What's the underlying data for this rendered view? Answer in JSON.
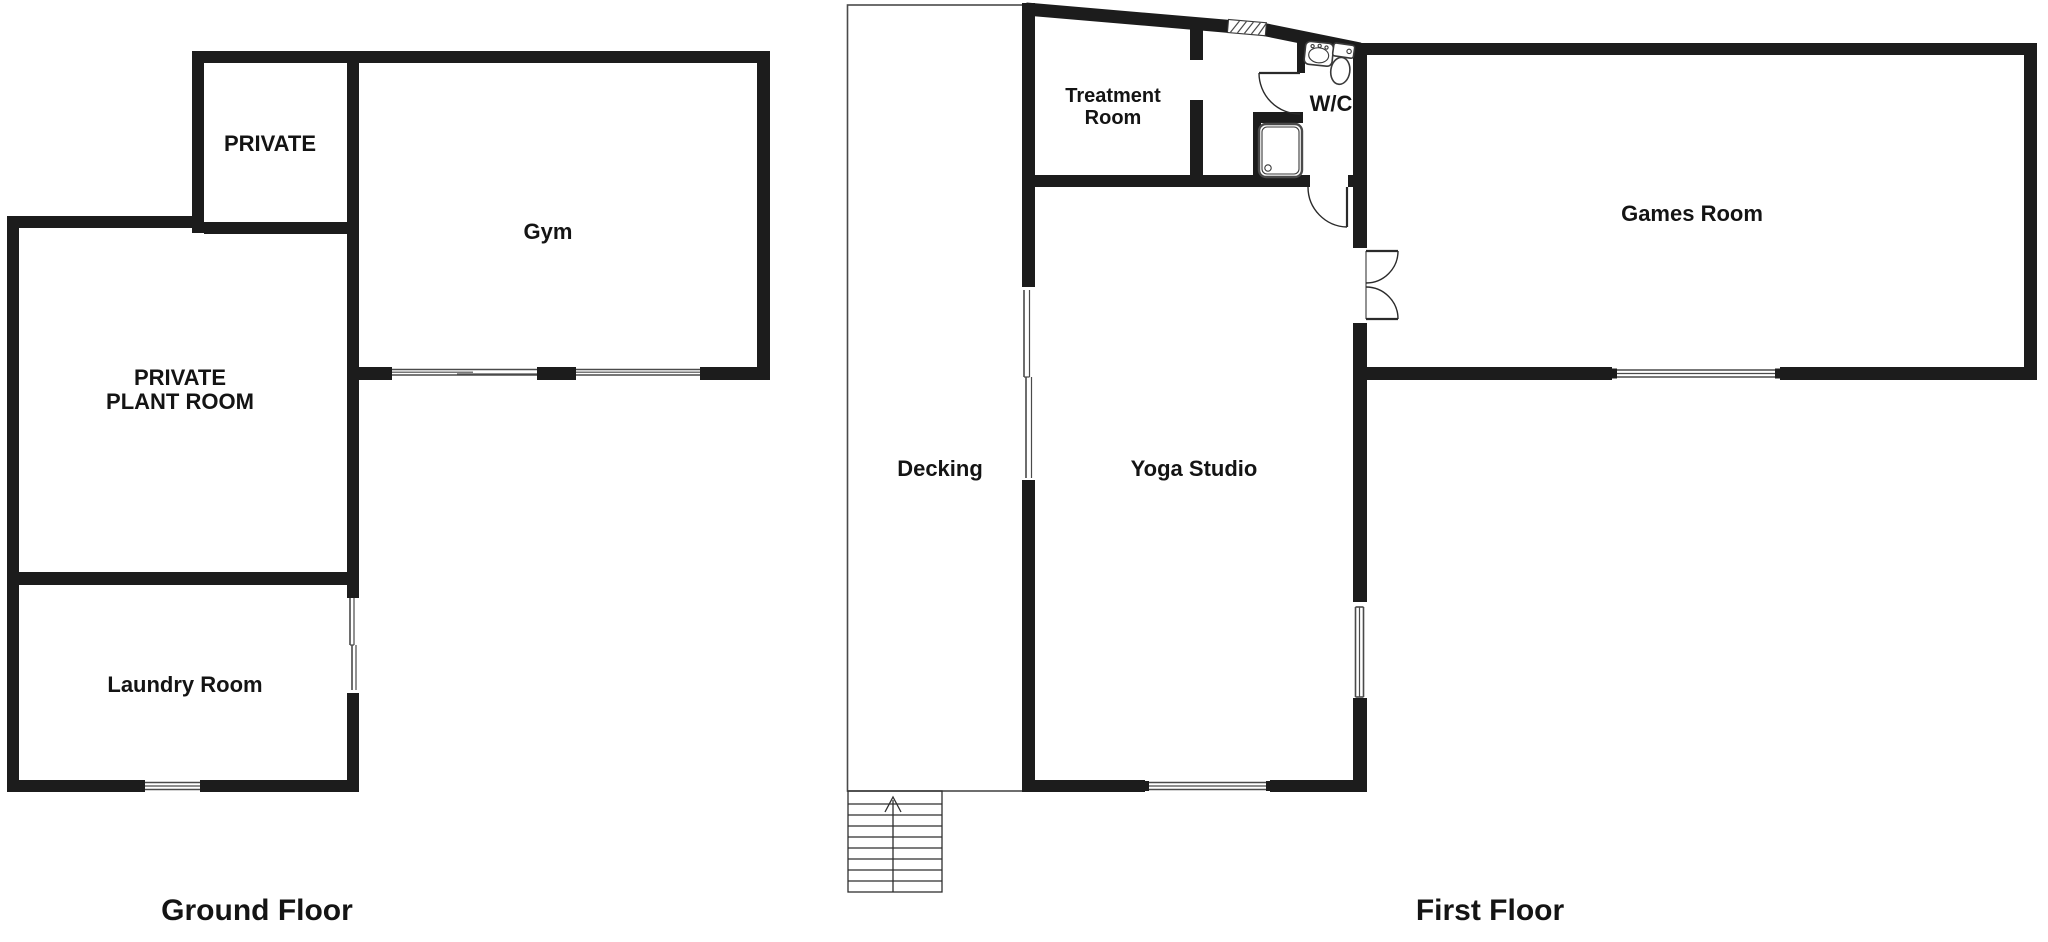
{
  "colors": {
    "wall": "#1c1c1c",
    "line": "#4a4a4a",
    "text": "#141414",
    "bg": "#ffffff"
  },
  "ground_floor": {
    "title": "Ground Floor",
    "rooms": {
      "private": {
        "label": "PRIVATE"
      },
      "gym": {
        "label": "Gym"
      },
      "plant": {
        "label_line1": "PRIVATE",
        "label_line2": "PLANT ROOM"
      },
      "laundry": {
        "label": "Laundry Room"
      }
    }
  },
  "first_floor": {
    "title": "First Floor",
    "rooms": {
      "treatment": {
        "label_line1": "Treatment",
        "label_line2": "Room"
      },
      "wc": {
        "label": "W/C"
      },
      "games": {
        "label": "Games Room"
      },
      "decking": {
        "label": "Decking"
      },
      "yoga": {
        "label": "Yoga Studio"
      }
    },
    "stairs": {
      "direction": "up"
    }
  }
}
